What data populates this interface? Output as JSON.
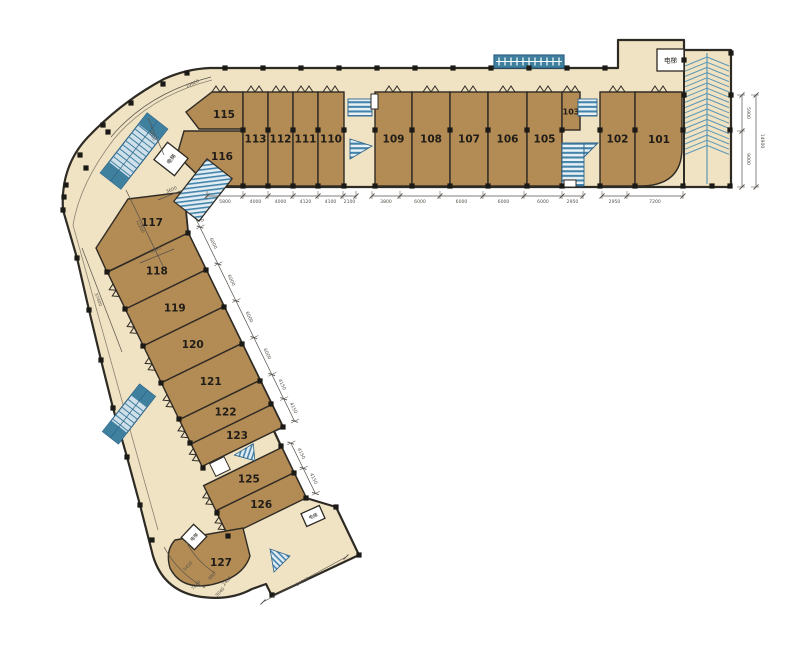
{
  "plan": {
    "elevator_label": "电梯",
    "rooms_top": [
      "115",
      "116",
      "113",
      "112",
      "111",
      "110",
      "109",
      "108",
      "107",
      "106",
      "105",
      "103",
      "102",
      "101"
    ],
    "rooms_wing": [
      "117",
      "118",
      "119",
      "120",
      "121",
      "122",
      "123",
      "125",
      "126",
      "127"
    ],
    "dims": {
      "top_a": [
        "5800",
        "4000",
        "4000",
        "4120",
        "4100",
        "2100"
      ],
      "top_b": [
        "3800",
        "6000",
        "6000",
        "6000",
        "6000",
        "2950"
      ],
      "top_c": [
        "2950",
        "7200"
      ],
      "right_inner": [
        "5900",
        "9000"
      ],
      "right_total": "14900",
      "wing": [
        "2750",
        "6000",
        "6000",
        "6000",
        "6000",
        "4150",
        "4150"
      ],
      "wing_lower": [
        "4150",
        "4150"
      ],
      "left_arc": "19920",
      "left_bend": "4600",
      "left_stair": "3600",
      "left_mid": "12200",
      "left_outer": "37400",
      "left_small": "5000",
      "bottom_small": [
        "5420",
        "7040",
        "980",
        "2480",
        "3040"
      ],
      "bottom_total": "14000"
    },
    "colors": {
      "room_fill": "#b28b55",
      "walkway_fill": "#f0e3c3",
      "wall": "#2e2a24",
      "stair_blue": "#40809f",
      "stair_dark": "#2c6288",
      "ramp_line": "#5e97b5",
      "dim": "#56514b",
      "label": "#201d18"
    }
  }
}
